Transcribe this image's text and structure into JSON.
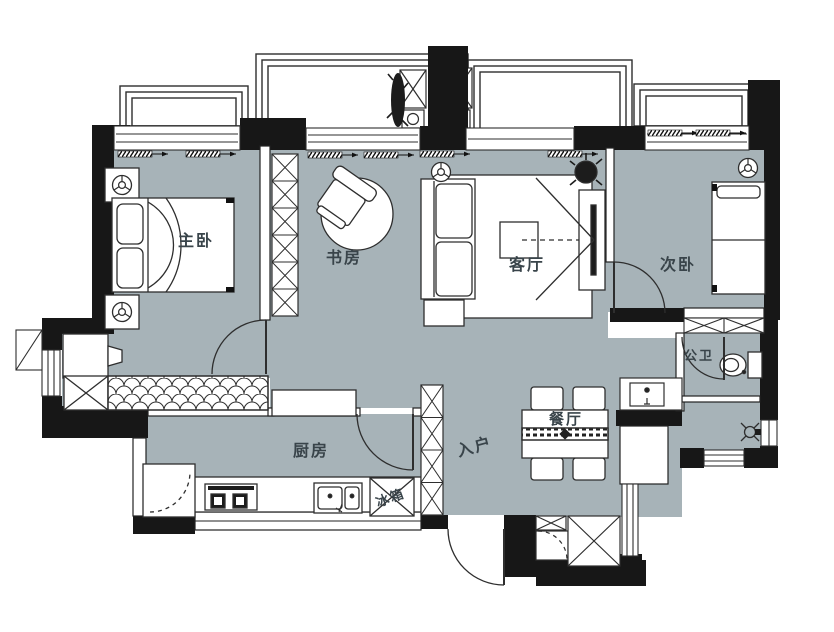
{
  "plan": {
    "type_note": "residential floor plan",
    "colors": {
      "floor": "#a7b3b8",
      "wall": "#171717",
      "line": "#2e2e2e",
      "label": "#39444a",
      "white": "#ffffff"
    },
    "rooms": {
      "master_bedroom": {
        "label": "主卧"
      },
      "study": {
        "label": "书房"
      },
      "living_room": {
        "label": "客厅"
      },
      "second_bedroom": {
        "label": "次卧"
      },
      "bathroom": {
        "label": "公卫"
      },
      "dining_room": {
        "label": "餐厅"
      },
      "kitchen": {
        "label": "厨房"
      },
      "entrance": {
        "label": "入户"
      }
    },
    "appliances": {
      "fridge": {
        "label": "冰箱"
      }
    }
  }
}
